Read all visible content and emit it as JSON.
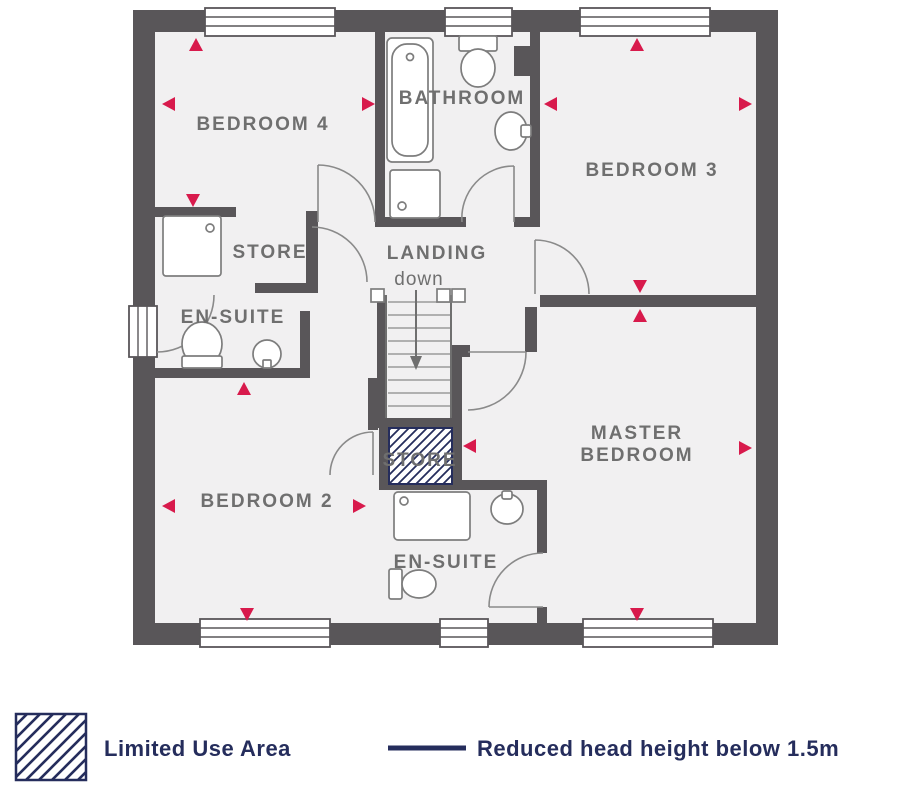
{
  "plan": {
    "rooms": {
      "bedroom4": "BEDROOM 4",
      "bathroom": "BATHROOM",
      "bedroom3": "BEDROOM 3",
      "store_left": "STORE",
      "ensuite_left": "EN-SUITE",
      "landing": "LANDING",
      "landing_sub": "down",
      "store_hatched": "STORE",
      "bedroom2": "BEDROOM 2",
      "master_line1": "MASTER",
      "master_line2": "BEDROOM",
      "ensuite_bottom": "EN-SUITE"
    }
  },
  "legend": {
    "limited_use": "Limited Use Area",
    "reduced_head": "Reduced head height below 1.5m"
  },
  "colors": {
    "wall": "#595659",
    "floor": "#f1f0f1",
    "accent_red": "#d81a4c",
    "navy": "#252d5c",
    "label_gray": "#6f6f6f"
  }
}
